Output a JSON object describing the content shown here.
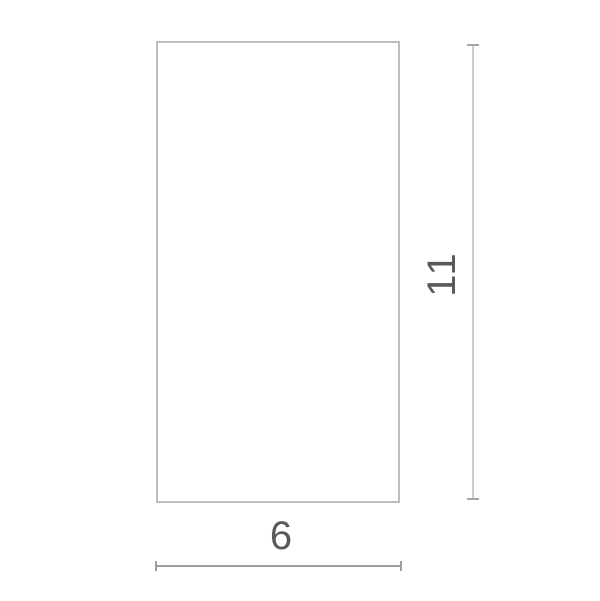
{
  "diagram": {
    "shape": "rectangle",
    "labels": {
      "height": "11",
      "width": "6"
    },
    "values": {
      "width": 6,
      "height": 11
    },
    "colors": {
      "background": "#ffffff",
      "rectangle_border": "#bdbdbd",
      "vertical_dimension_line": "#cdcdcd",
      "vertical_dimension_tick": "#a3a3a3",
      "horizontal_dimension_line": "#9e9e9e",
      "label_text": "#58595b"
    }
  }
}
